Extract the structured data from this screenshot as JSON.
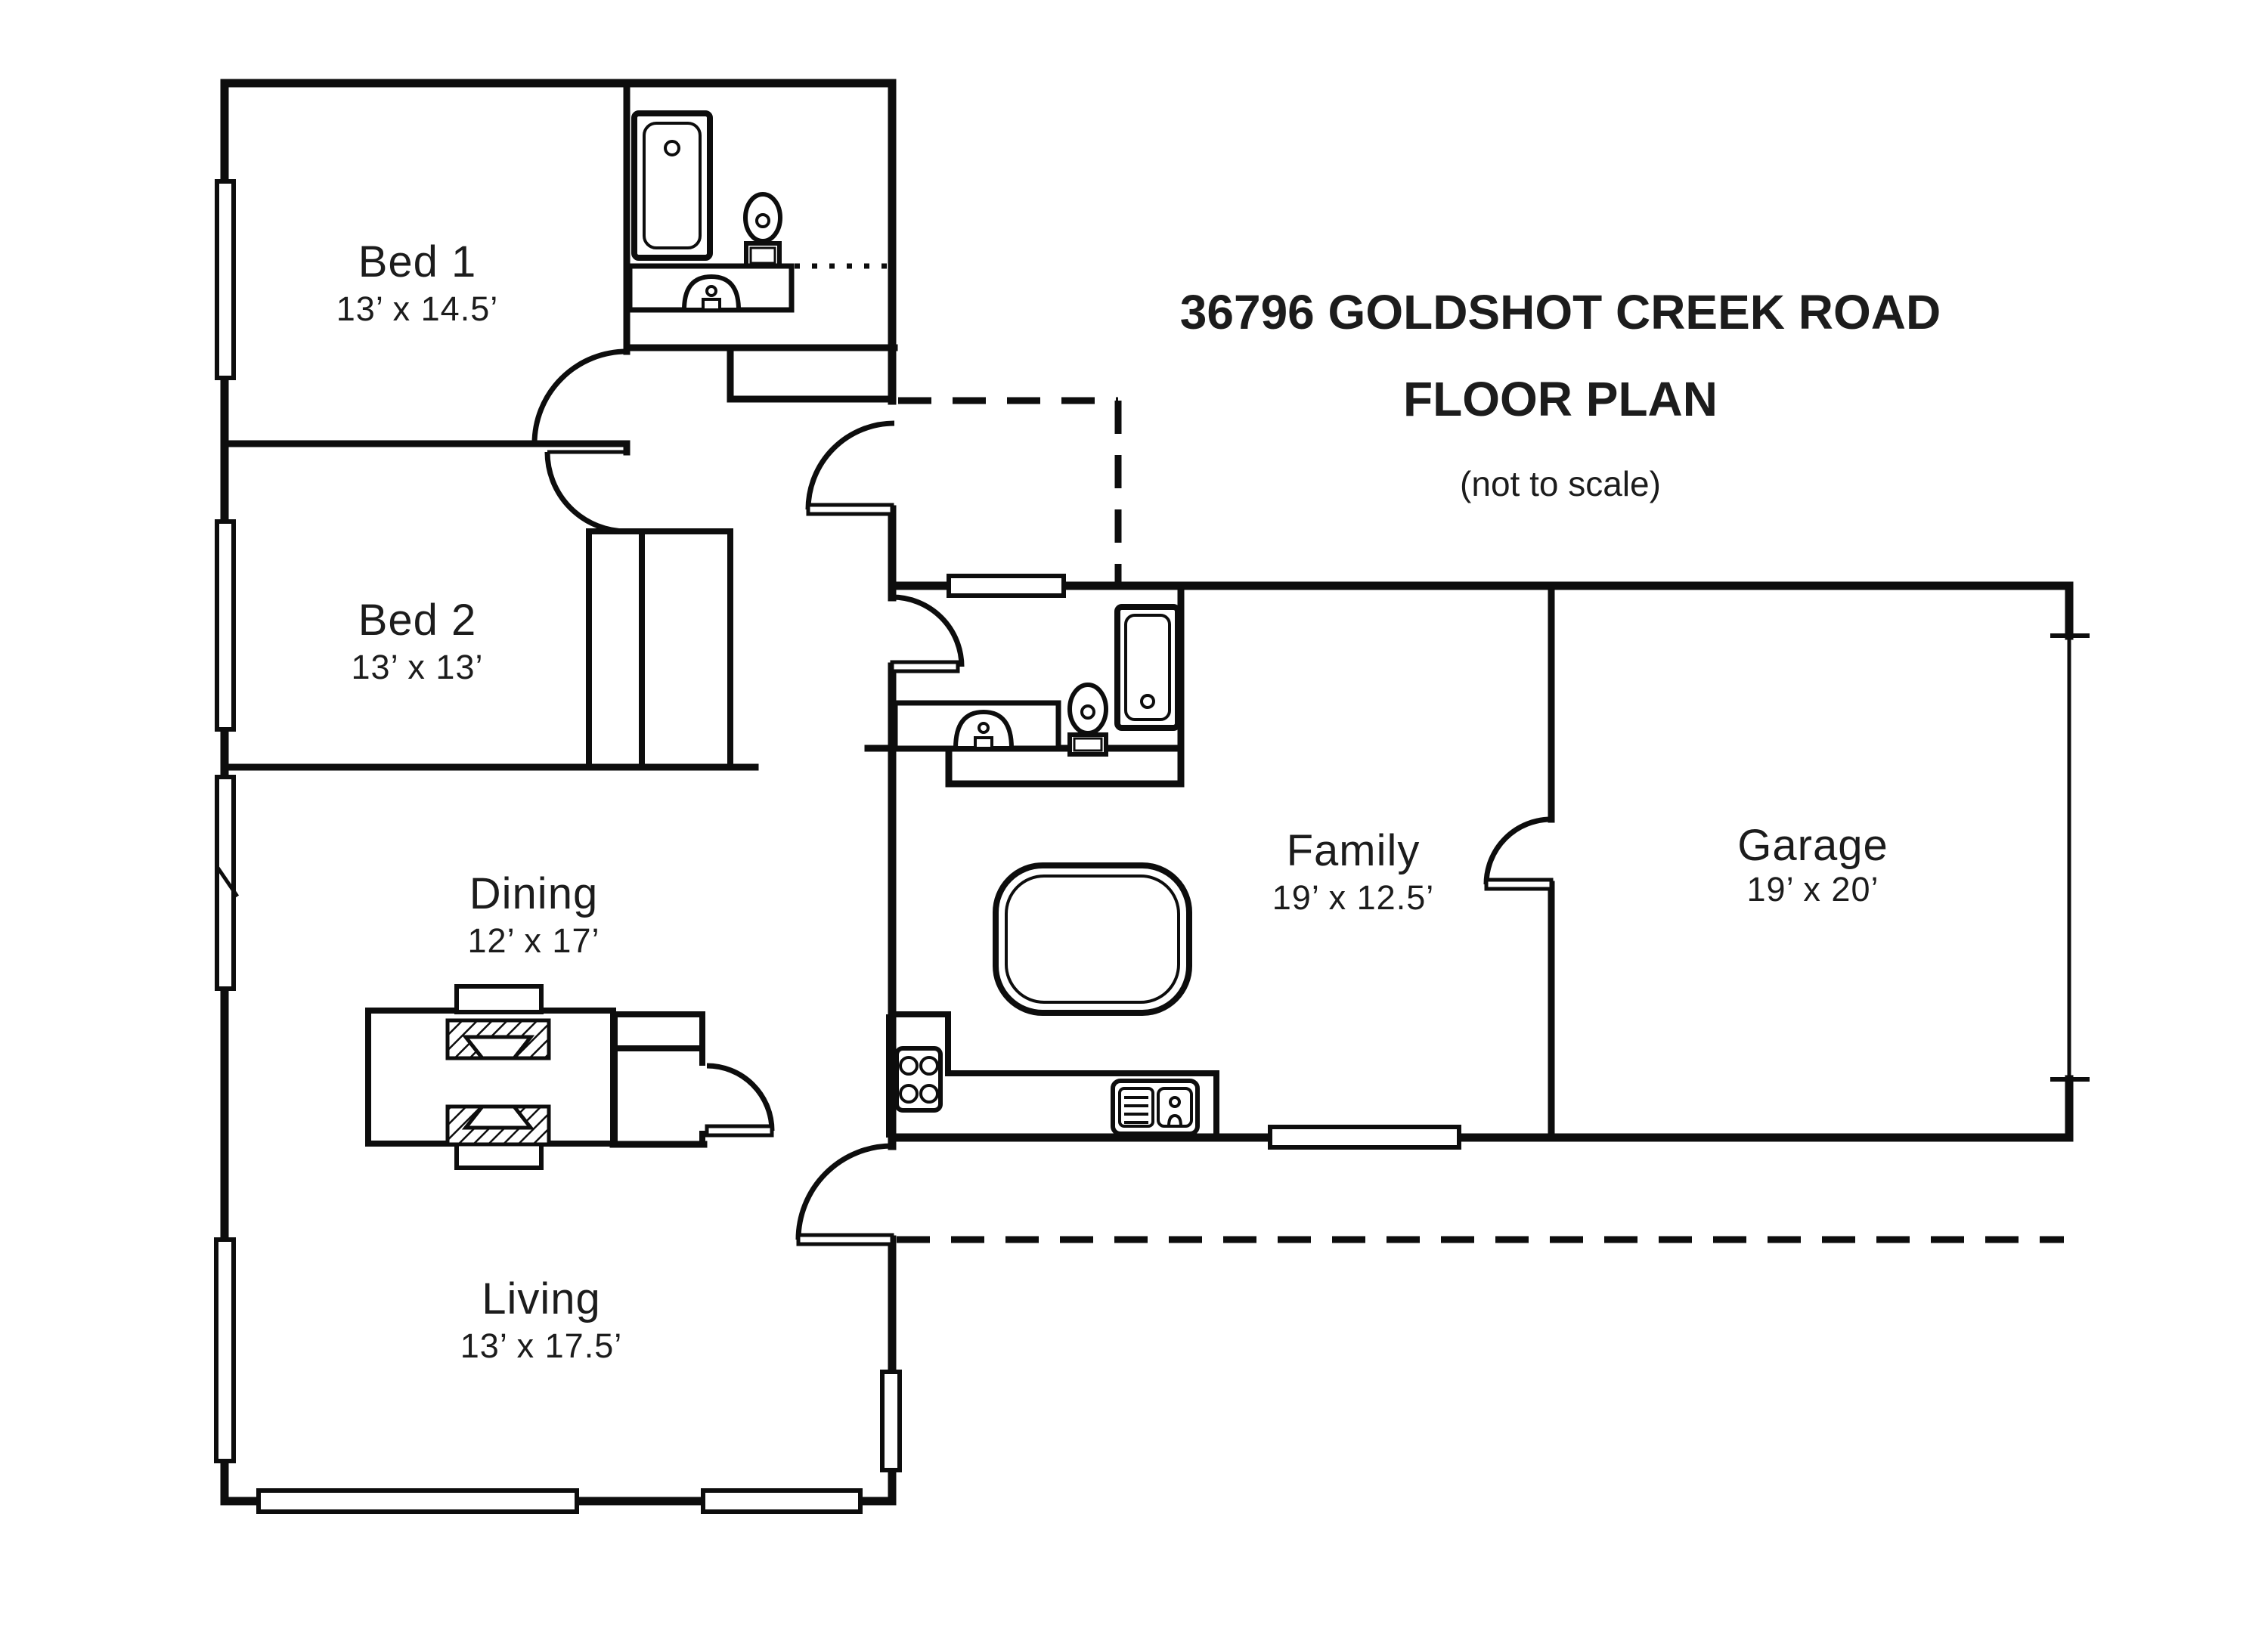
{
  "title": {
    "line1": "36796 GOLDSHOT CREEK ROAD",
    "line2": "FLOOR PLAN",
    "line3": "(not to scale)"
  },
  "rooms": [
    {
      "id": "bed1",
      "name": "Bed 1",
      "dims": "13’ x 14.5’"
    },
    {
      "id": "bed2",
      "name": "Bed 2",
      "dims": "13’ x 13’"
    },
    {
      "id": "dining",
      "name": "Dining",
      "dims": "12’ x 17’"
    },
    {
      "id": "living",
      "name": "Living",
      "dims": "13’ x 17.5’"
    },
    {
      "id": "family",
      "name": "Family",
      "dims": "19’ x 12.5’"
    },
    {
      "id": "garage",
      "name": "Garage",
      "dims": "19’ x 20’"
    }
  ],
  "icons": [
    "bathtub",
    "toilet",
    "sink-vanity",
    "kitchen-sink",
    "stove",
    "kitchen-island",
    "dining-table",
    "dining-chair",
    "closet",
    "window",
    "door-swing",
    "porch-dashed-outline",
    "patio-dashed-line"
  ],
  "colors": {
    "ink": "#0d0d0d",
    "background": "#ffffff"
  }
}
